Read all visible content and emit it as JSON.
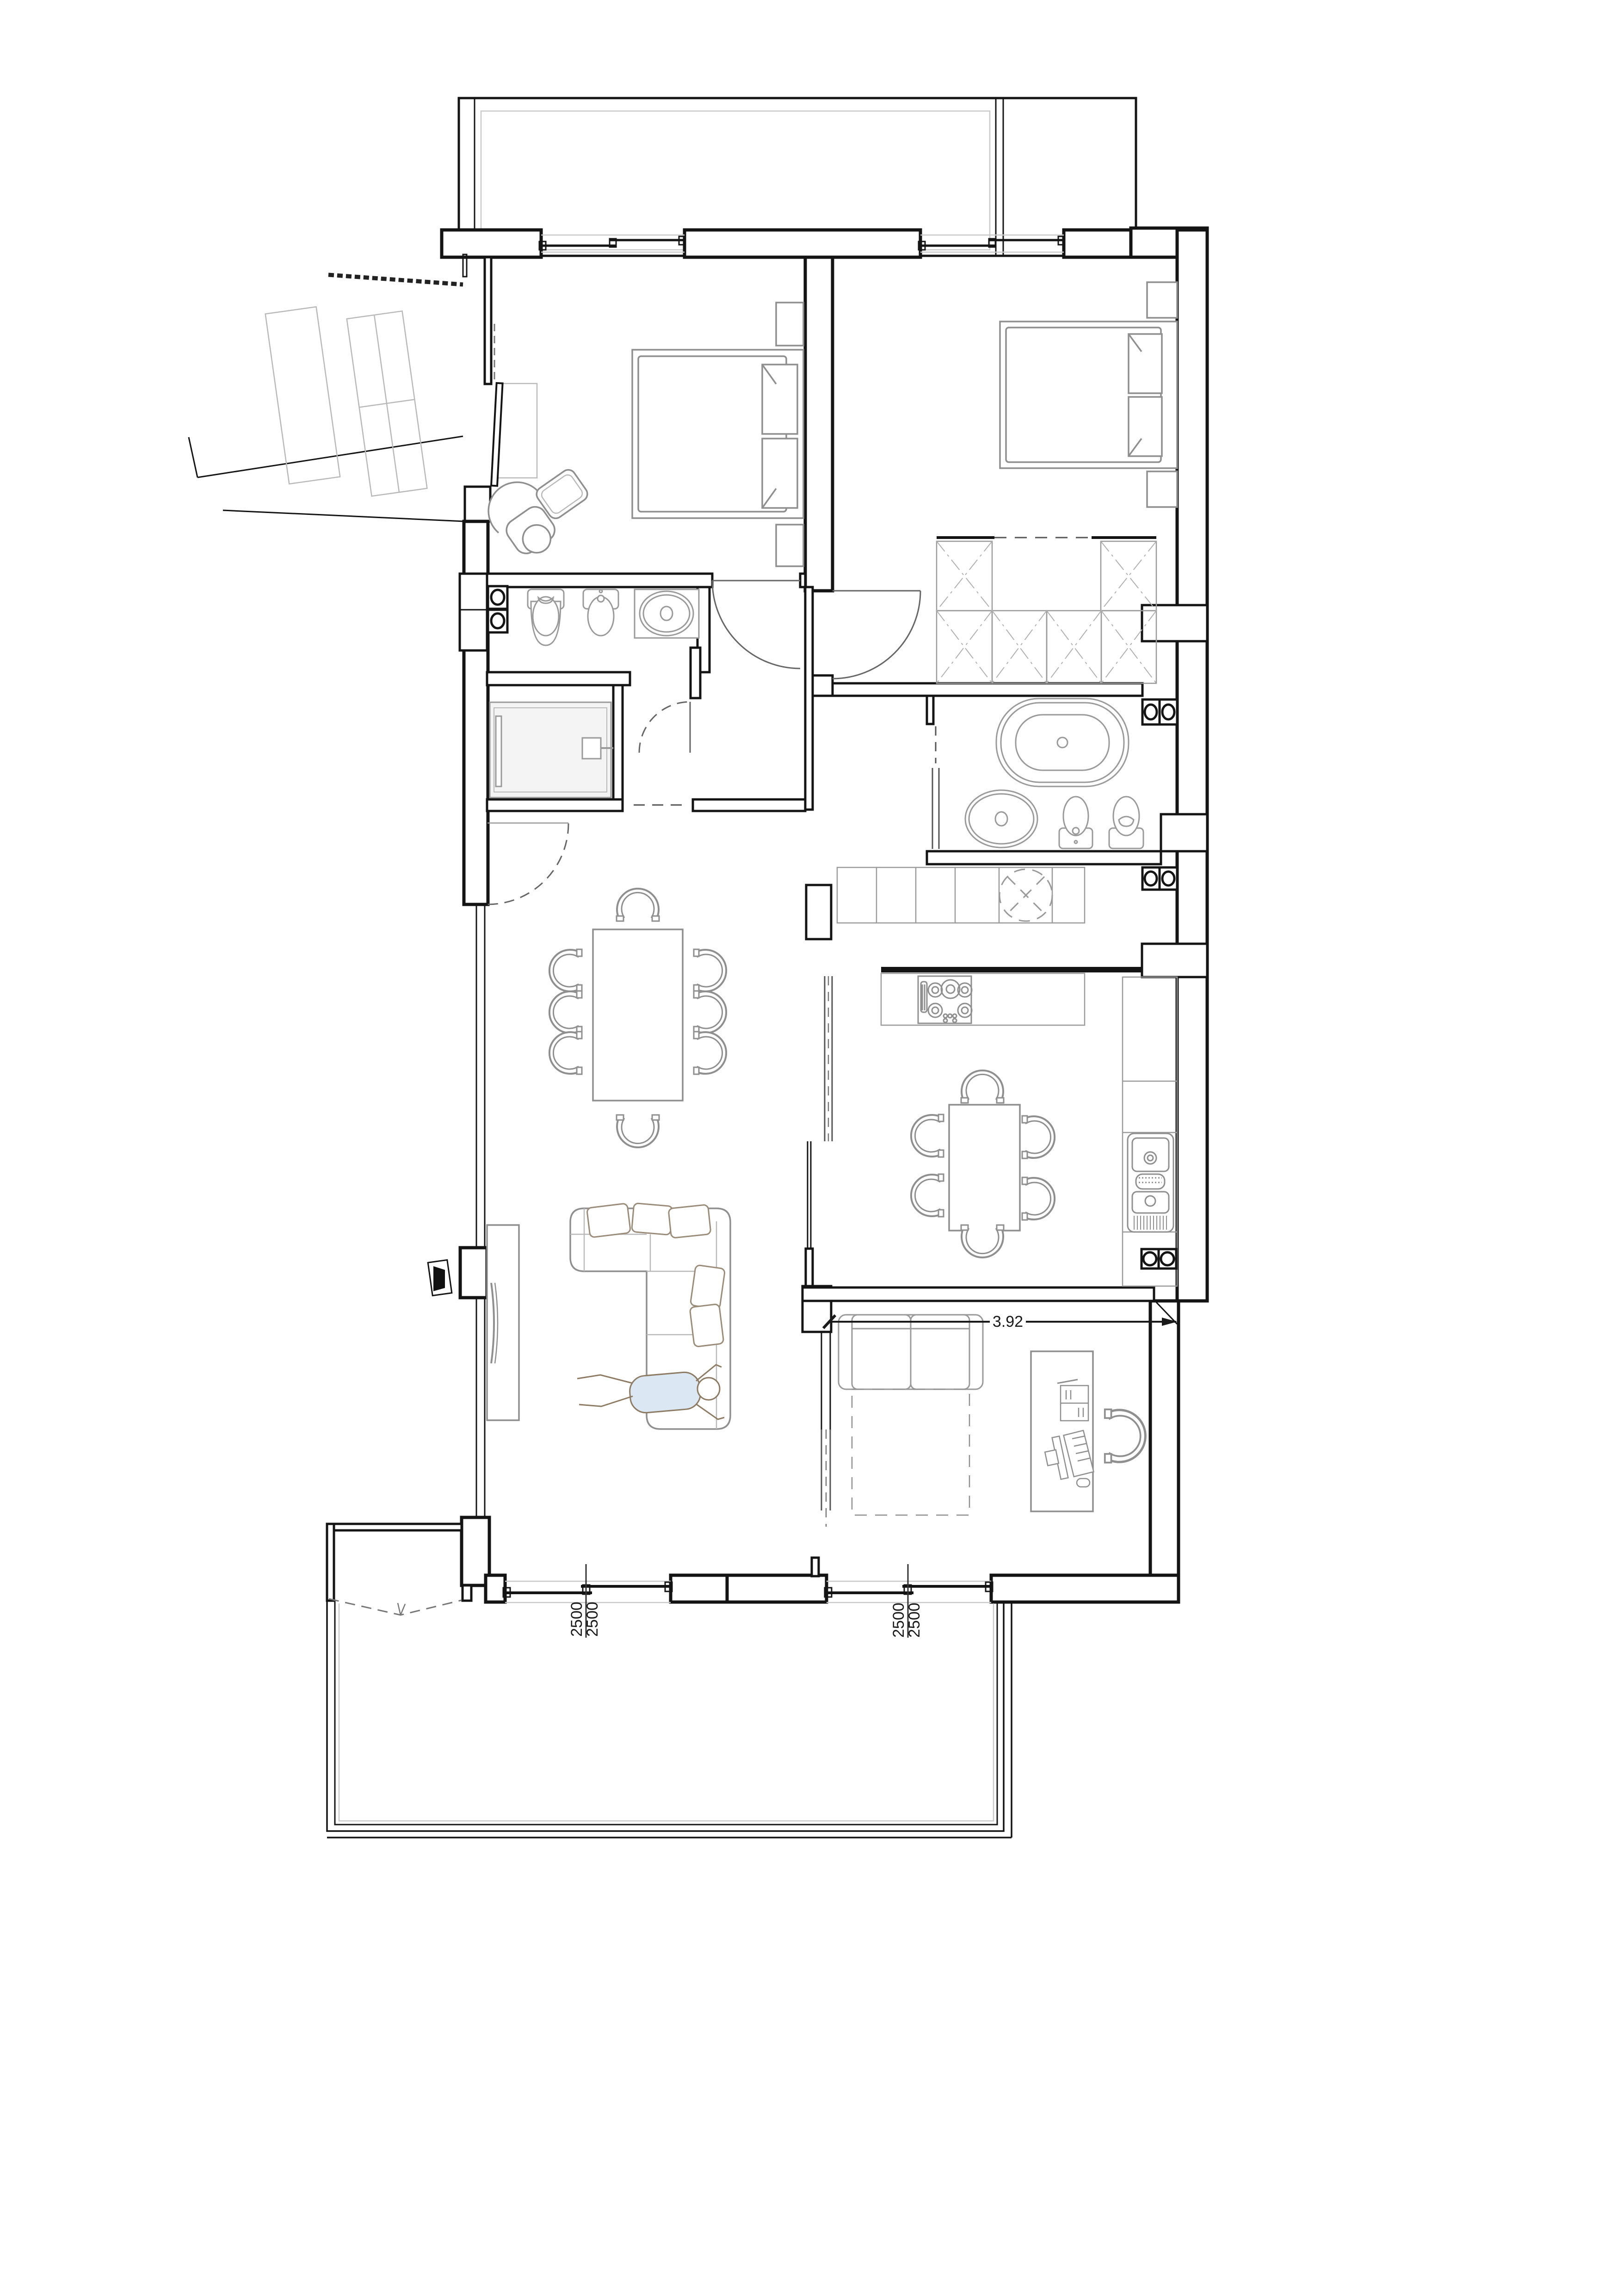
{
  "page": {
    "title": "Apartment floor plan drawing"
  },
  "colors": {
    "wall": "#141414",
    "furniture": "#8f8f8f",
    "furniture_light": "#b9b9b9",
    "fixture_fill": "#f4f4f4",
    "glass": "#555555",
    "dimension_text": "#1a1a1a",
    "person_outline": "#8d7b63",
    "person_shirt": "#dbe7f3",
    "background": "#ffffff"
  },
  "labels": {
    "office_dim": "3.92",
    "left_window_dim_1": "2500",
    "left_window_dim_2": "2500",
    "right_window_dim_1": "2500",
    "right_window_dim_2": "2500"
  },
  "symbols": [
    "entry-stairs",
    "entry-door",
    "double-bed",
    "nightstand",
    "armchair",
    "side-table",
    "wardrobe-x-section",
    "walk-in-shower",
    "washer-dryer-stack",
    "toilet",
    "bidet",
    "washbasin",
    "freestanding-bathtub",
    "gas-hob-5-burner",
    "extractor-vent",
    "kitchen-sink-double",
    "dining-table-8-chairs",
    "kitchen-table-6-chairs",
    "sectional-sofa",
    "person-lying",
    "tv-console",
    "television",
    "desk",
    "computer-monitor",
    "keyboard",
    "mouse",
    "notebook",
    "office-chair",
    "sofa-bed",
    "sliding-door",
    "hinged-door-swing",
    "balcony",
    "window-sliding"
  ]
}
